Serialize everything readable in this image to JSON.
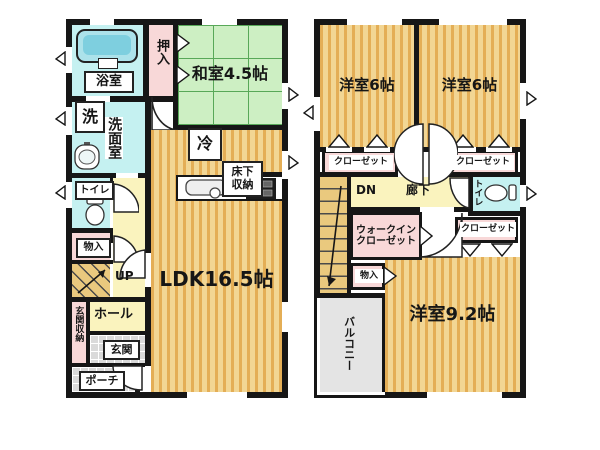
{
  "floor1": {
    "bathroom": "浴室",
    "oshiire": "押入",
    "washitsu": "和室4.5帖",
    "washer": "洗",
    "washroom": "洗面室",
    "fridge": "冷",
    "floor_storage_line1": "床下",
    "floor_storage_line2": "収納",
    "ldk": "LDK16.5帖",
    "toilet": "トイレ",
    "storage": "物入",
    "stairs_up": "UP",
    "hall": "ホール",
    "entrance_storage": "玄関収納",
    "entrance": "玄関",
    "porch": "ポーチ"
  },
  "floor2": {
    "bedroom_left": "洋室6帖",
    "bedroom_right": "洋室6帖",
    "closet_top_left": "クローゼット",
    "closet_top_right": "クローゼット",
    "stairs_down": "DN",
    "corridor": "廊下",
    "toilet": "トイレ",
    "wic_line1": "ウォークイン",
    "wic_line2": "クローゼット",
    "closet_mid_right": "クローゼット",
    "storage": "物入",
    "balcony": "バルコニー",
    "bedroom_main": "洋室9.2帖"
  },
  "colors": {
    "wall": "#161616",
    "wood_base": "#f2d694",
    "wood_stripe": "#e4ae56",
    "tatami_green": "#cdefc3",
    "tatami_grid": "#58a858",
    "water_cyan": "#c5f1f1",
    "closet_pink": "#f8d8d8",
    "hall_yellow": "#faf3be",
    "stair_tan": "#eac97e",
    "tile_gray": "#dadada",
    "balcony_gray": "#e4e4e4"
  }
}
